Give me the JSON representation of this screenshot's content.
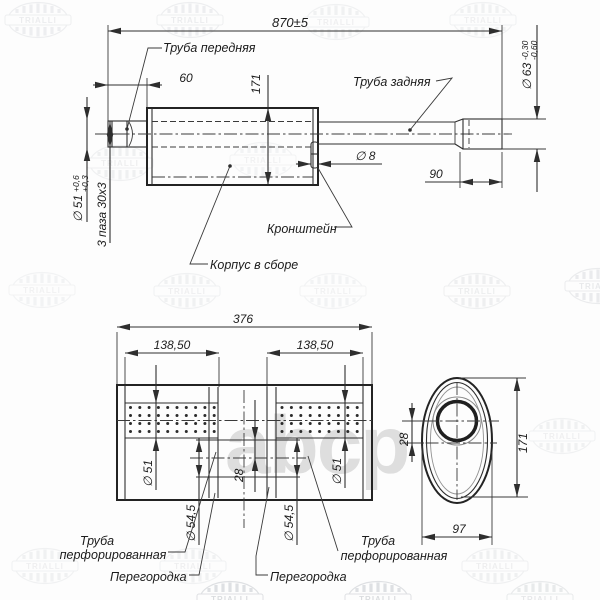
{
  "meta": {
    "brand": "TRIALLI",
    "watermark": "abcp"
  },
  "top": {
    "overall": "870±5",
    "front_len": "60",
    "height": "171",
    "front_pipe": "Труба передняя",
    "rear_pipe": "Труба задняя",
    "hole": "∅ 8",
    "bracket": "Кронштейн",
    "body": "Корпус в сборе",
    "rear_len": "90",
    "rear_dia": "∅ 63",
    "rear_tol_u": "-0,30",
    "rear_tol_l": "-0,60",
    "front_dia": "∅ 51",
    "front_tol_u": "+0,6",
    "front_tol_l": "+0,3",
    "slots": "3 паза 30х3"
  },
  "section": {
    "length": "376",
    "chamber_l": "138,50",
    "chamber_r": "138,50",
    "pipe_dia_l": "∅ 51",
    "pipe_dia_r": "∅ 51",
    "sleeve_dia_l": "∅ 54,5",
    "sleeve_dia_r": "∅ 54,5",
    "offset": "28",
    "pipe_word_l": "Труба",
    "pipe_word2_l": "перфорированная",
    "baffle_l": "Перегородка",
    "baffle_r": "Перегородка",
    "pipe_word_r": "Труба",
    "pipe_word2_r": "перфорированная"
  },
  "end": {
    "offset": "28",
    "height": "171",
    "width": "97"
  }
}
